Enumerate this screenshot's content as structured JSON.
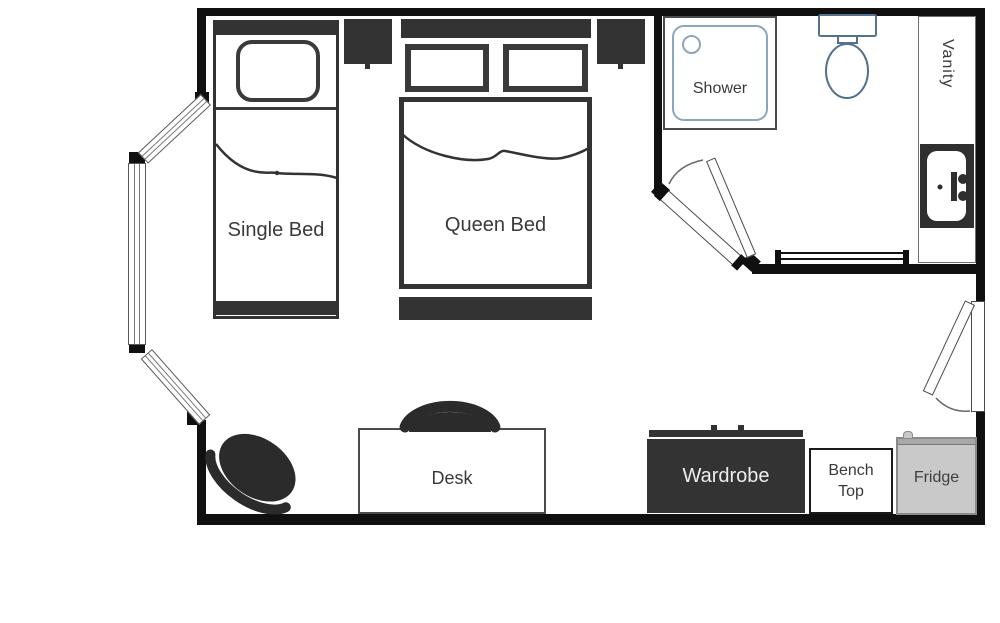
{
  "floor_plan": {
    "labels": {
      "single_bed": "Single Bed",
      "queen_bed": "Queen Bed",
      "shower": "Shower",
      "vanity": "Vanity",
      "desk": "Desk",
      "wardrobe": "Wardrobe",
      "bench_top": "Bench Top",
      "fridge": "Fridge"
    },
    "rooms": [
      "bedroom-living-area",
      "bathroom"
    ],
    "unlabeled_fixtures": [
      "toilet",
      "sink",
      "bay-window",
      "entry-door",
      "bathroom-door",
      "nightstand",
      "nightstand",
      "desk-chair",
      "lounge-chair",
      "towel-rail",
      "wardrobe-rail"
    ],
    "colors": {
      "wall": "#101010",
      "furniture_dark": "#333333",
      "chair": "#2b2b2b",
      "bathroom_fixture_stroke": "#54718e",
      "shower_inner_stroke": "#8ca6bd",
      "fridge_fill": "#c9c9c9",
      "fridge_border": "#8a8a8a",
      "label_text": "#3a3a3a",
      "wardrobe_label_text": "#ededed",
      "background": "#ffffff"
    }
  }
}
